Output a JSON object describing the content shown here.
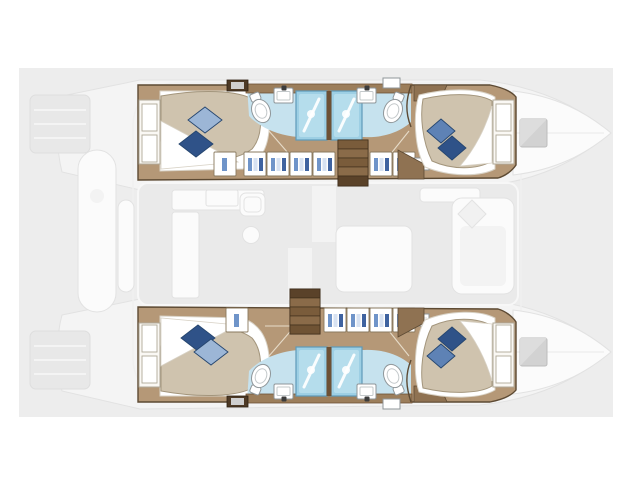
{
  "canvas": {
    "width": 640,
    "height": 480
  },
  "colors": {
    "panel": "#ededed",
    "ghost_fill": "#f4f4f4",
    "ghost_stroke": "#e2e2e2",
    "ghost_white": "#fbfbfb",
    "wood_floor": "#b59877",
    "wood_counter": "#9c7e5b",
    "wood_cabinet": "#8f7252",
    "wood_dark": "#6d5135",
    "wall": "#5d4a33",
    "stair_light": "#8a6b49",
    "stair_mid": "#7a5c3b",
    "stair_dark": "#5a4229",
    "mattress": "#cfc3ae",
    "mattress_stroke": "#a3957c",
    "bed_white": "#ffffff",
    "sheet_stroke": "#d8d2c6",
    "headboard": "#faf8f4",
    "headboard_stroke": "#b0a998",
    "pillow_light": "#9cb6d6",
    "pillow_mid": "#5e82b5",
    "pillow_dark": "#2f5288",
    "pillow_stroke": "#26466f",
    "bath_floor": "#c6e2ee",
    "shower_fill": "#9dcfe4",
    "shower_inner": "#bfe2ef",
    "shower_stroke": "#5e9ab9",
    "fixture_white": "#ffffff",
    "fixture_stroke": "#8f9699",
    "item_blue": "#6f94c9",
    "item_navy": "#3f63a0",
    "item_pale": "#d7e2f2",
    "hatch_fill": "#d2d2d2",
    "hatch_stroke": "#bcbcbc"
  },
  "plan": {
    "vessel": {
      "type": "catamaran",
      "view": "top-down accommodation plan",
      "bow_direction": "right"
    },
    "hulls": [
      {
        "label": "Starboard hull (top)",
        "rooms": [
          "aft double cabin",
          "aft bathroom",
          "forward bathroom",
          "forward double cabin"
        ],
        "fixtures": {
          "showers": 2,
          "toilets": 2,
          "sinks": 2
        },
        "features": [
          "companionway stairs",
          "storage lockers",
          "bow deck hatch"
        ]
      },
      {
        "label": "Port hull (bottom)",
        "rooms": [
          "aft double cabin",
          "aft bathroom",
          "forward bathroom",
          "forward double cabin"
        ],
        "fixtures": {
          "showers": 2,
          "toilets": 2,
          "sinks": 2
        },
        "features": [
          "companionway stairs",
          "storage lockers",
          "bow deck hatch"
        ]
      }
    ],
    "saloon": {
      "label": "Main-deck saloon (ghosted)",
      "items": [
        "galley counters",
        "galley sink",
        "dining table",
        "lounge seating",
        "companionway openings"
      ]
    },
    "exterior": {
      "label": "Exterior decks (ghosted)",
      "items": [
        "transom steps",
        "aft platform",
        "cockpit bench",
        "bow peaks",
        "foredeck hatches"
      ]
    },
    "counts": {
      "cabins": 4,
      "beds": 4,
      "pillows": 8,
      "showers": 4,
      "toilets": 4,
      "sinks": 4,
      "staircases": 2,
      "deck_hatches": 2
    }
  }
}
